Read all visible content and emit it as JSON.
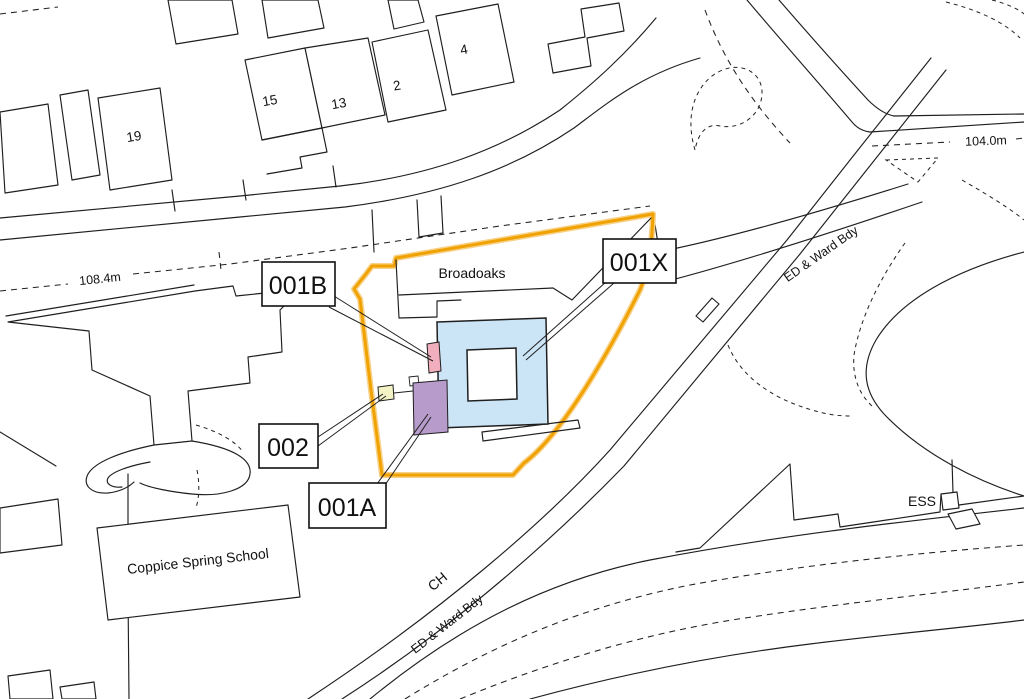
{
  "map": {
    "parcel_labels": {
      "b001B": "001B",
      "b001X": "001X",
      "b002": "002",
      "b001A": "001A"
    },
    "place_labels": {
      "broadoaks": "Broadoaks",
      "school": "Coppice Spring School",
      "ess": "ESS",
      "ch": "CH",
      "ward_bdy_ne": "ED & Ward Bdy",
      "ward_bdy_s": "ED & Ward Bdy"
    },
    "elevations": {
      "left": "108.4m",
      "right": "104.0m"
    },
    "house_numbers": [
      "19",
      "15",
      "13",
      "2",
      "4"
    ],
    "colors": {
      "site_boundary": "#F0A202",
      "site_boundary_halo": "#F8D187",
      "parcel_blue": "#CBE4F6",
      "parcel_pink": "#F1AFBD",
      "parcel_purple": "#B79BCB",
      "parcel_yellow": "#F3F3C6",
      "line": "#1f1f1f"
    }
  }
}
